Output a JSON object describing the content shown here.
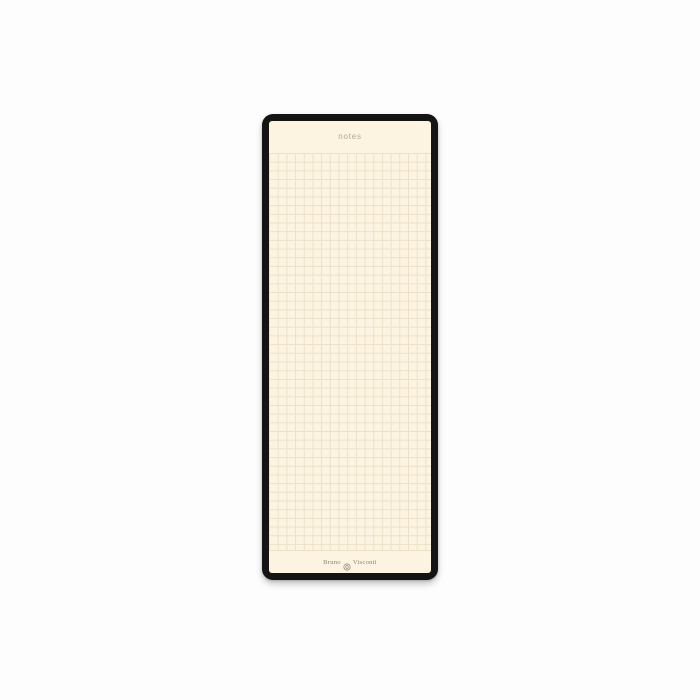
{
  "scene": {
    "description": "Product photo of a tall narrow notepad with black cover edge and cream squared (grid) paper, centered on a white background",
    "canvas_bg": "#fdfdfd"
  },
  "notepad": {
    "header_label": "notes",
    "brand": {
      "left": "Bruno",
      "right": "Visconti",
      "emblem": "circular-monogram-emblem"
    },
    "colors": {
      "cover": "#141414",
      "paper": "#fcf4e1",
      "grid_line": "#ece0c8",
      "header_text": "#b2a694",
      "brand_text": "#8b8173"
    },
    "grid": {
      "cell_px": 8.7,
      "pattern": "square-grid"
    }
  }
}
